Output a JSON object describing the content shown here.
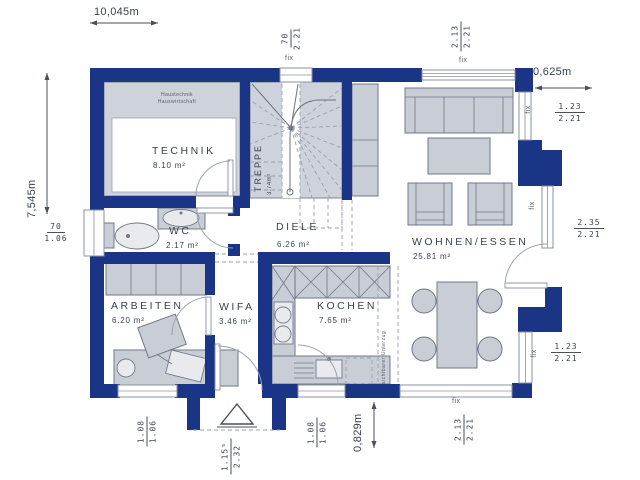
{
  "dimensions": {
    "total_width": "10,045m",
    "total_height": "7,545m",
    "offset_right": "0,625m",
    "offset_bottom": "0,829m"
  },
  "windows": {
    "fix_label": "fix",
    "top_stairs": {
      "num": "70",
      "den": "2.21"
    },
    "top_living": {
      "num": "2.13",
      "den": "2.21"
    },
    "right_upper": {
      "num": "1.23",
      "den": "2.21"
    },
    "right_terrace_door": {
      "num": "2.35",
      "den": "2.21"
    },
    "right_lower": {
      "num": "1.23",
      "den": "2.21"
    },
    "bottom_living": {
      "num": "2.13",
      "den": "2.21"
    },
    "bottom_kitchen": {
      "num": "1.08",
      "den": "1.06"
    },
    "entrance_door": {
      "num": "1.15⁵",
      "den": "2.32"
    },
    "bottom_office": {
      "num": "1.08",
      "den": "1.06"
    },
    "left_wc": {
      "num": "70",
      "den": "1.06"
    }
  },
  "rooms": {
    "technik": {
      "name": "TECHNIK",
      "area": "8.10 m²",
      "note_line1": "Haustechnik",
      "note_line2": "Hauswirtschaft"
    },
    "treppe": {
      "name": "TREPPE",
      "area": "3.74m²"
    },
    "diele": {
      "name": "DIELE",
      "area": "6.26 m²"
    },
    "wc": {
      "name": "WC",
      "area": "2.17 m²"
    },
    "arbeiten": {
      "name": "ARBEITEN",
      "area": "6.20 m²"
    },
    "wifa": {
      "name": "WIFA",
      "area": "3.46 m²"
    },
    "kochen": {
      "name": "KOCHEN",
      "area": "7.65 m²"
    },
    "wohnen_essen": {
      "name": "WOHNEN/ESSEN",
      "area": "25.81 m²"
    }
  },
  "annotations": {
    "beam": "sichtbarer Unterzug"
  },
  "colors": {
    "wall": "#1a3486",
    "room_fill": "#ced2da",
    "furniture_fill": "#c9cdd6",
    "outline": "#707888"
  }
}
